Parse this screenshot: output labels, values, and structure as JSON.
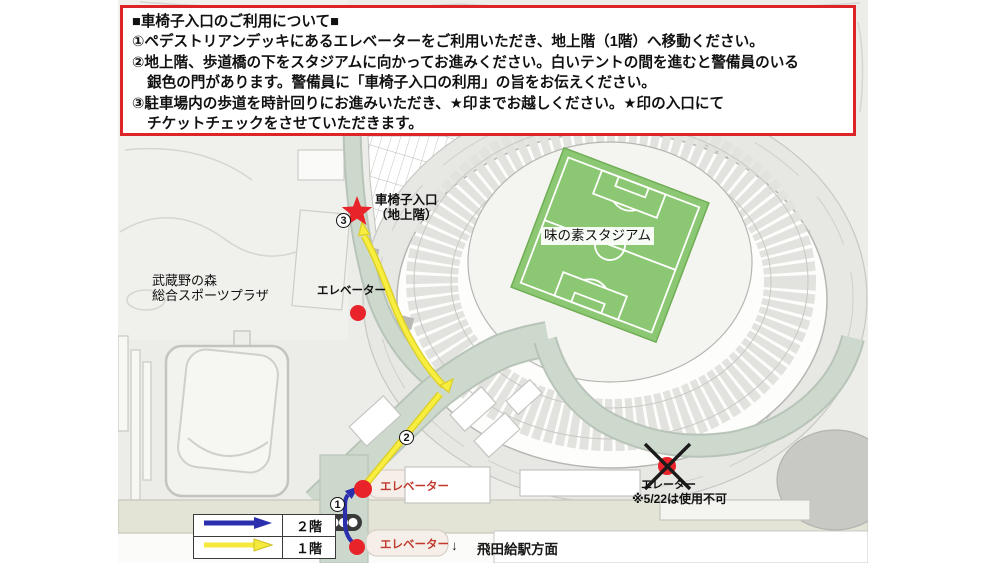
{
  "info_box": {
    "line1": "■車椅子入口のご利用について■",
    "line2": "①ペデストリアンデッキにあるエレベーターをご利用いただき、地上階（1階）へ移動ください。",
    "line3": "②地上階、歩道橋の下をスタジアムに向かってお進みください。白いテントの間を進むと警備員のいる",
    "line4": "銀色の門があります。警備員に「車椅子入口の利用」の旨をお伝えください。",
    "line5": "③駐車場内の歩道を時計回りにお進みいただき、★印までお越しください。★印の入口にて",
    "line6": "チケットチェックをさせていただきます。"
  },
  "map": {
    "stadium_label": "味の素スタジアム",
    "plaza_label": "武蔵野の森\n総合スポーツプラザ",
    "wheelchair_entrance_label": "車椅子入口\n（地上階）",
    "elevator_mid_label": "エレベーター",
    "elevator_deck_label": "エレベーター",
    "elevator_station_label": "エレベーター",
    "elevator_east_label": "エレーター",
    "elevator_east_note": "※5/22は使用不可",
    "station_direction_arrow": "↓",
    "station_direction_label": "飛田給駅方面",
    "marker_1": "1",
    "marker_2": "2",
    "marker_3": "3"
  },
  "legend": {
    "floor2_label": "２階",
    "floor1_label": "１階"
  },
  "colors": {
    "info_border_red": "#dd2426",
    "route_2f_blue": "#2b2fae",
    "route_1f_yellow": "#f5e93d",
    "marker_red": "#e8232a",
    "field_green": "#8cc873",
    "road_sage": "#ccd8cb",
    "road_beige": "#e3e3d6"
  }
}
